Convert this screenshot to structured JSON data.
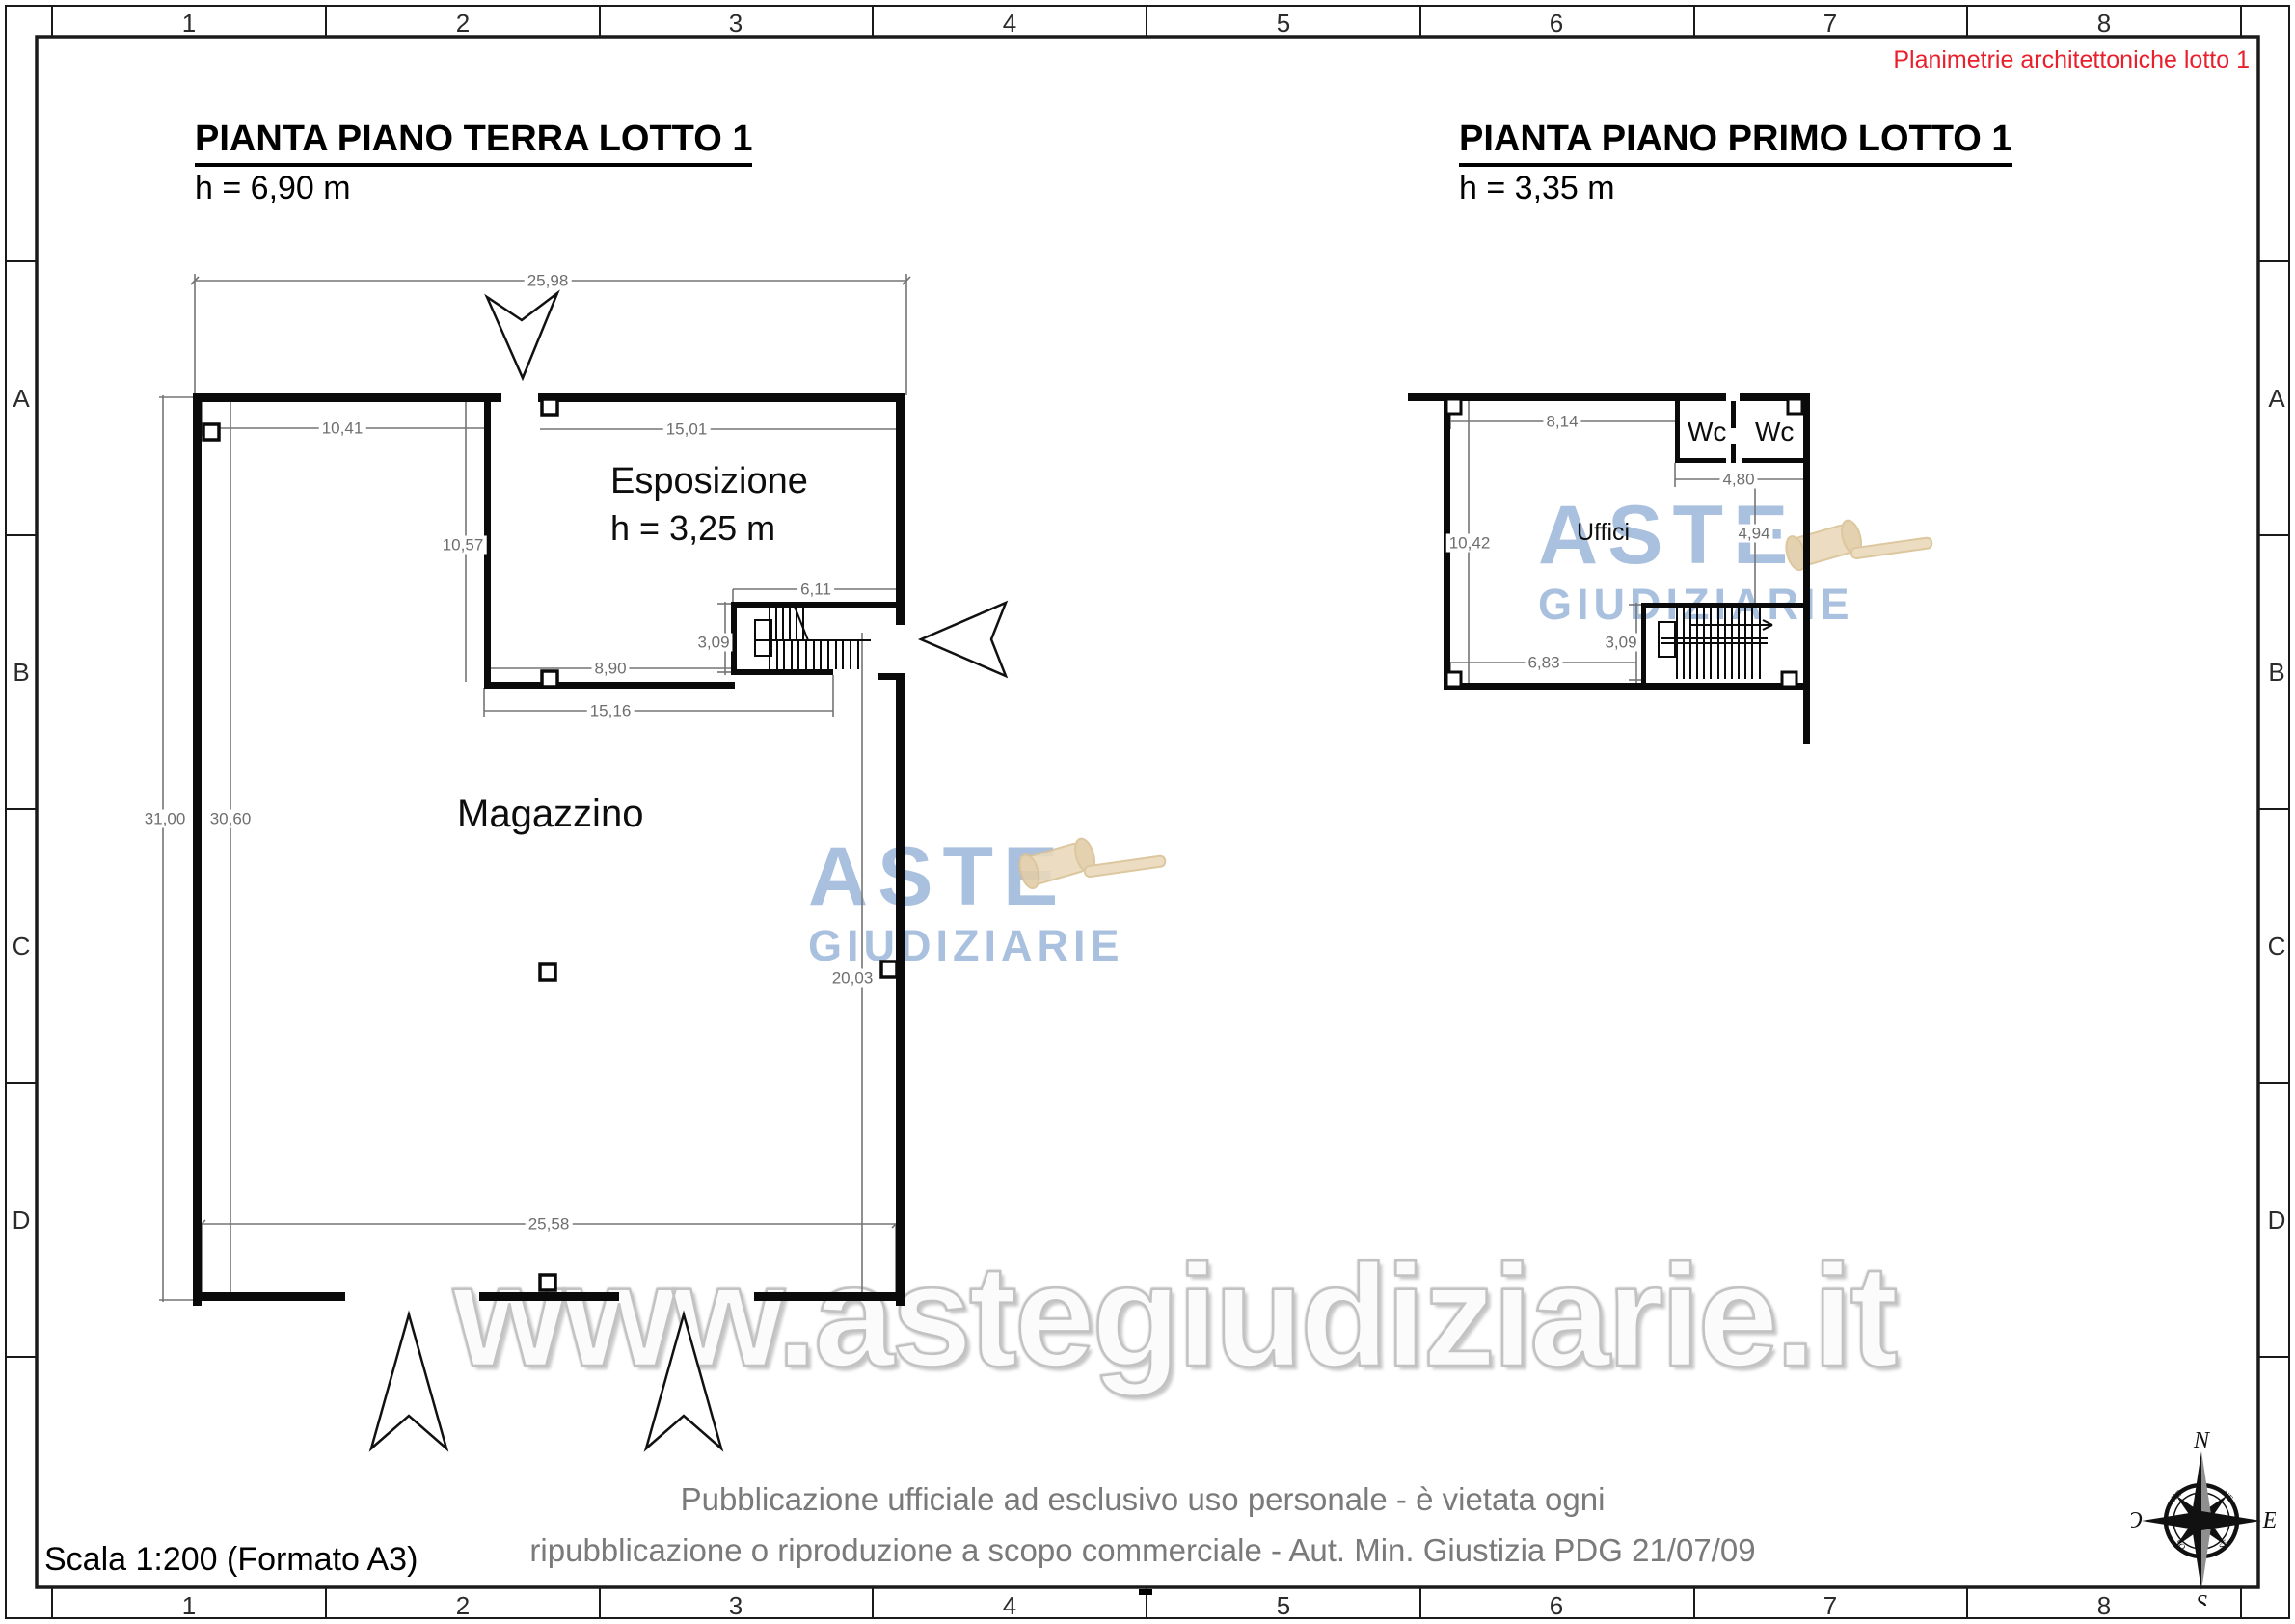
{
  "page": {
    "header_note": "Planimetrie architettoniche lotto 1",
    "scale_label": "Scala 1:200 (Formato A3)",
    "disclaimer_line1": "Pubblicazione ufficiale ad esclusivo uso personale - è vietata ogni",
    "disclaimer_line2": "ripubblicazione o riproduzione a scopo commerciale - Aut. Min. Giustizia PDG 21/07/09",
    "watermark_url": "www.astegiudiziarie.it",
    "watermark_brand_line1": "ASTE",
    "watermark_brand_line2": "GIUDIZIARIE"
  },
  "grid": {
    "cols": [
      "1",
      "2",
      "3",
      "4",
      "5",
      "6",
      "7",
      "8"
    ],
    "rows": [
      "A",
      "B",
      "C",
      "D"
    ]
  },
  "ground_floor": {
    "title": "PIANTA PIANO TERRA LOTTO 1",
    "height_label": "h = 6,90 m",
    "room_esposizione": "Esposizione",
    "room_esposizione_h": "h = 3,25 m",
    "room_magazzino": "Magazzino",
    "dims": {
      "overall_top": "25,98",
      "magazzino_top_width": "10,41",
      "esposizione_width": "15,01",
      "esposizione_depth": "10,57",
      "stair_width": "6,11",
      "stair_depth": "3,09",
      "esposizione_bottom": "8,90",
      "esposizione_total_width": "15,16",
      "overall_left_height": "31,00",
      "magazzino_inner_height": "30,60",
      "magazzino_right_height": "20,03",
      "bottom_width": "25,58"
    }
  },
  "first_floor": {
    "title": "PIANTA PIANO PRIMO LOTTO 1",
    "height_label": "h = 3,35 m",
    "room_wc1": "Wc",
    "room_wc2": "Wc",
    "room_uffici": "Uffici",
    "dims": {
      "uffici_top_width": "8,14",
      "wc_width": "4,80",
      "left_height": "10,42",
      "right_height": "4,94",
      "stair_depth": "3,09",
      "bottom_width": "6,83"
    }
  },
  "compass": {
    "n": "N",
    "s": "S",
    "e": "E",
    "o": "O",
    "ne": "NE",
    "se": "SE",
    "so": "SO",
    "no": "NO"
  },
  "colors": {
    "note_red": "#e8202c",
    "dim_gray": "#6e6e6e",
    "line_black": "#0a0a0a",
    "watermark_blue": "#a9c0de",
    "watermark_gray": "#c2c2c2",
    "gavel_tan": "#ead9bb"
  }
}
